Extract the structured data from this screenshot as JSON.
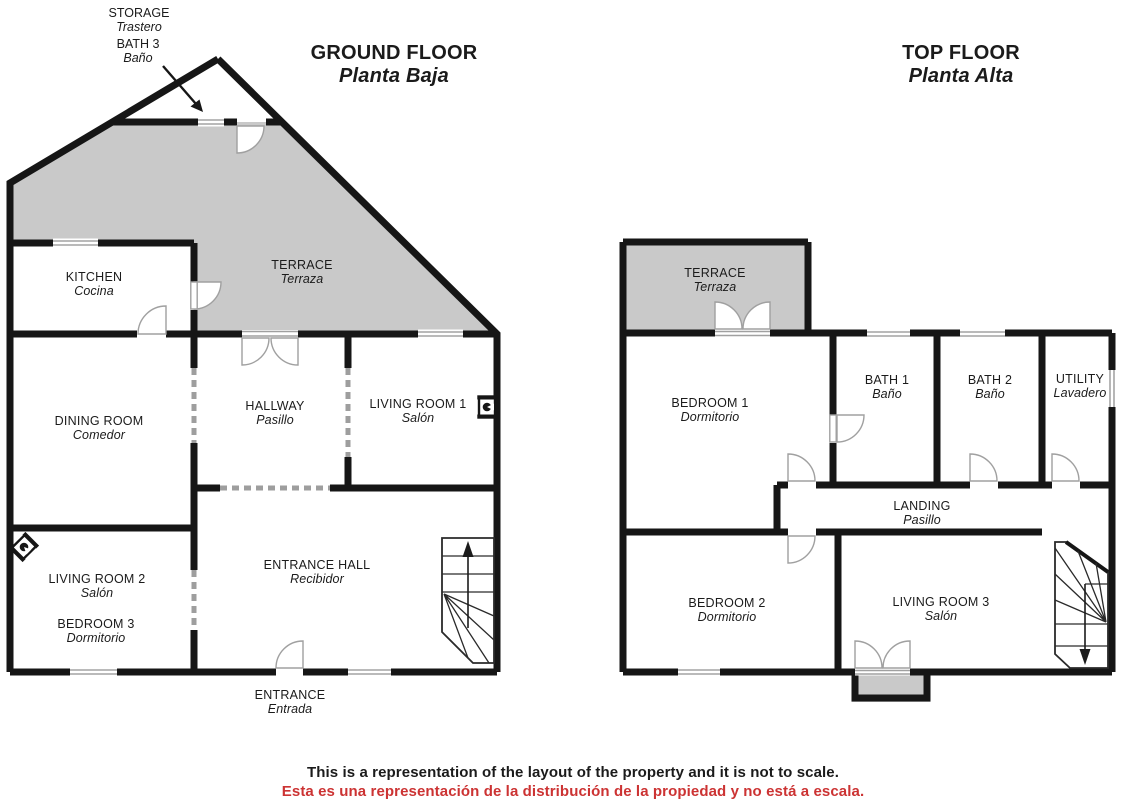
{
  "titles": {
    "ground": {
      "name": "GROUND FLOOR",
      "name_es": "Planta Baja"
    },
    "top": {
      "name": "TOP FLOOR",
      "name_es": "Planta Alta"
    }
  },
  "callout": {
    "storage": {
      "name": "STORAGE",
      "name_es": "Trastero"
    },
    "bath3": {
      "name": "BATH 3",
      "name_es": "Baño"
    }
  },
  "rooms": {
    "kitchen": {
      "name": "KITCHEN",
      "name_es": "Cocina"
    },
    "terrace_ground": {
      "name": "TERRACE",
      "name_es": "Terraza"
    },
    "dining": {
      "name": "DINING ROOM",
      "name_es": "Comedor"
    },
    "hallway": {
      "name": "HALLWAY",
      "name_es": "Pasillo"
    },
    "living1": {
      "name": "LIVING ROOM 1",
      "name_es": "Salón"
    },
    "living2": {
      "name": "LIVING ROOM 2",
      "name_es": "Salón"
    },
    "bedroom3": {
      "name": "BEDROOM 3",
      "name_es": "Dormitorio"
    },
    "entrance_hall": {
      "name": "ENTRANCE HALL",
      "name_es": "Recibidor"
    },
    "entrance": {
      "name": "ENTRANCE",
      "name_es": "Entrada"
    },
    "terrace_top": {
      "name": "TERRACE",
      "name_es": "Terraza"
    },
    "bedroom1": {
      "name": "BEDROOM 1",
      "name_es": "Dormitorio"
    },
    "bath1": {
      "name": "BATH 1",
      "name_es": "Baño"
    },
    "bath2": {
      "name": "BATH 2",
      "name_es": "Baño"
    },
    "utility": {
      "name": "UTILITY",
      "name_es": "Lavadero"
    },
    "landing": {
      "name": "LANDING",
      "name_es": "Pasillo"
    },
    "bedroom2": {
      "name": "BEDROOM 2",
      "name_es": "Dormitorio"
    },
    "living3": {
      "name": "LIVING ROOM 3",
      "name_es": "Salón"
    }
  },
  "footer": {
    "en": "This is a representation of the layout of the property and it is not to scale.",
    "es": "Esta es una representación de la distribución de la propiedad y no está a escala."
  },
  "colors": {
    "wall": "#161616",
    "terrace_fill": "#c9c9c9",
    "door_line": "#a0a0a0",
    "window_line": "#909090",
    "open_wall_dash": "#9e9e9e",
    "footer_es": "#cc3333"
  },
  "icons": {
    "fireplace_living1": "fireplace-icon",
    "fireplace_living2": "fireplace-icon",
    "stairs_ground": "stairs-up-icon",
    "stairs_top": "stairs-down-icon",
    "storage_pointer": "arrow-icon"
  }
}
